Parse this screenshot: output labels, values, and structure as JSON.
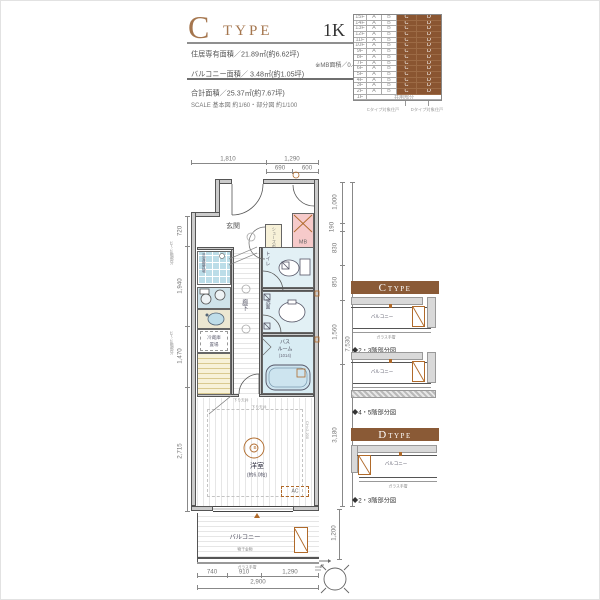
{
  "header": {
    "type_letter": "C",
    "type_word": "TYPE",
    "layout": "1K",
    "area_line": "住居専有面積／21.89㎡(約6.62坪)",
    "mb_note": "※MB面積／0.40㎡含む",
    "balcony_line": "バルコニー面積／ 3.48㎡(約1.05坪)",
    "total_line": "合計面積／25.37㎡(約7.67坪)",
    "scale_note": "SCALE 基本図 約1/60・部分図 約1/100"
  },
  "floor_table": {
    "floors": [
      "15F",
      "14F",
      "13F",
      "12F",
      "11F",
      "10F",
      "9F",
      "8F",
      "7F",
      "6F",
      "5F",
      "4F",
      "3F",
      "2F"
    ],
    "units": [
      "A",
      "B",
      "C",
      "D"
    ],
    "ground_floor": "1F",
    "ground_label": "共用部分",
    "note_c": "Cタイプ対象住戸",
    "note_d": "Dタイプ対象住戸"
  },
  "plan": {
    "rooms": {
      "genkan": "玄関",
      "mb": "MB",
      "shoes": "シューズボックス",
      "corridor": "廊下",
      "toilet": "トイレ",
      "wash": "洗面",
      "bath1": "バス",
      "bath2": "ルーム",
      "bath_size": "(1014)",
      "washer": "洗濯機置場",
      "fridge1": "冷蔵庫",
      "fridge2": "置場",
      "room": "洋室",
      "room_size": "(約6.0帖)",
      "light": "B",
      "ac": "AC",
      "balcony": "バルコニー",
      "hang": "物干金物",
      "rail": "ガラス手摺",
      "ceiling1": "下り天井",
      "ceiling2": "下り天井",
      "ch_note": "CH=2,200",
      "floor_note1": "12〜15階部分",
      "floor_note2": "12〜15階部分"
    },
    "dims": {
      "top1": "1,810",
      "top2": "1,290",
      "top2a": "690",
      "top2b": "600",
      "left1": "720",
      "left2": "1,940",
      "left3": "1,470",
      "left4": "2,715",
      "right1": "1,000",
      "right2": "190",
      "right3": "830",
      "right4": "850",
      "right5": "1,560",
      "right6": "3,180",
      "right_total": "7,530",
      "right_balcony": "1,200",
      "bottom1": "740",
      "bottom2": "910",
      "bottom3": "1,290",
      "bottom_total": "2,900"
    }
  },
  "partials": {
    "c_letter": "C",
    "c_word": "TYPE",
    "d_letter": "D",
    "d_word": "TYPE",
    "balcony": "バルコニー",
    "rail": "ガラス手摺",
    "cap1": "◆2・3階部分図",
    "cap2": "◆4・5階部分図",
    "cap3": "◆2・3階部分図"
  }
}
